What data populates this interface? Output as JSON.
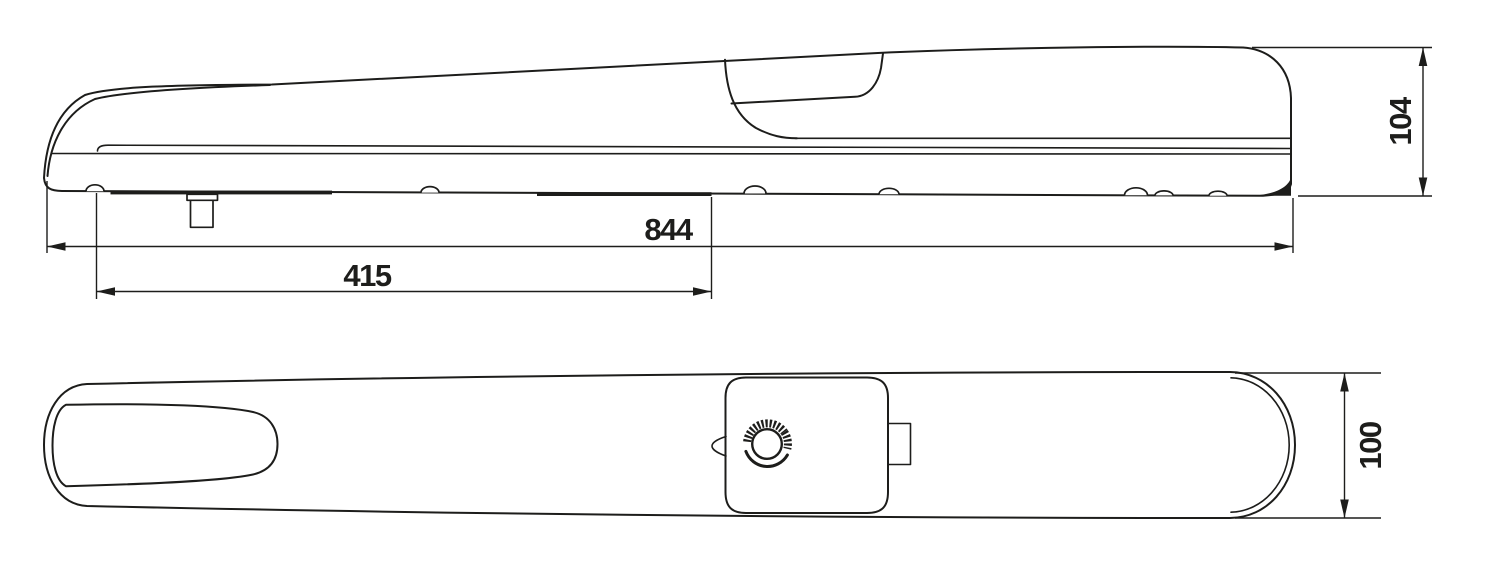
{
  "colors": {
    "line": "#1d1d1b",
    "background": "#ffffff"
  },
  "dimensions": {
    "overall_length": "844",
    "front_mount_distance": "415",
    "side_height": "104",
    "top_width": "100"
  },
  "icons": {
    "release_knob": "release-knob-icon"
  }
}
